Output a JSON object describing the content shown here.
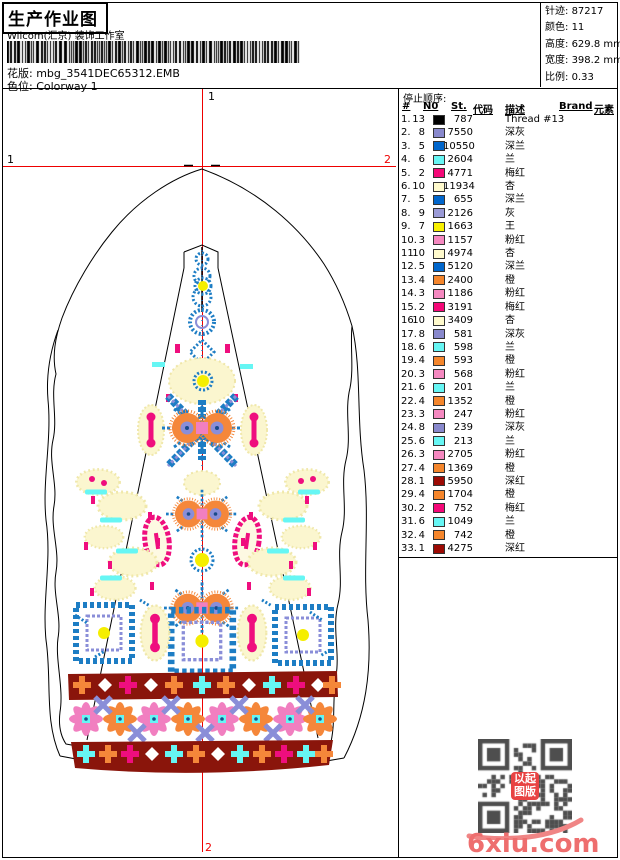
{
  "header": {
    "title": "生产作业图",
    "studio": "Wilcom(汇京) 装饰工作室",
    "pattern_label": "花版:",
    "pattern_value": "mbg_3541DEC65312.EMB",
    "colorway_label": "色位:",
    "colorway_value": "Colorway 1",
    "stats": [
      {
        "label": "针迹:",
        "value": "87217"
      },
      {
        "label": "颜色:",
        "value": "11"
      },
      {
        "label": "高度:",
        "value": "629.8 mm"
      },
      {
        "label": "宽度:",
        "value": "398.2 mm"
      },
      {
        "label": "比例:",
        "value": "0.33"
      }
    ]
  },
  "canvas": {
    "markers": {
      "top": "1",
      "left": "1",
      "right": "2",
      "bottom": "2"
    },
    "crosshair_color": "#ee0000"
  },
  "stop_sequence": {
    "heading": "停止顺序:",
    "columns": [
      "#",
      "N0",
      "St.",
      "代码",
      "描述",
      "Brand",
      "元素"
    ],
    "rows": [
      {
        "seq": "1.",
        "n": "13",
        "chip": "#000000",
        "st": "787",
        "desc": "Thread #13"
      },
      {
        "seq": "2.",
        "n": "8",
        "chip": "#8888cc",
        "st": "7550",
        "desc": "深灰"
      },
      {
        "seq": "3.",
        "n": "5",
        "chip": "#0066cc",
        "st": "10550",
        "desc": "深兰"
      },
      {
        "seq": "4.",
        "n": "6",
        "chip": "#66f6f4",
        "st": "2604",
        "desc": "兰"
      },
      {
        "seq": "5.",
        "n": "2",
        "chip": "#f50878",
        "st": "4771",
        "desc": "梅红"
      },
      {
        "seq": "6.",
        "n": "10",
        "chip": "#fffacc",
        "st": "11934",
        "desc": "杏"
      },
      {
        "seq": "7.",
        "n": "5",
        "chip": "#0066cc",
        "st": "655",
        "desc": "深兰"
      },
      {
        "seq": "8.",
        "n": "9",
        "chip": "#9a9ad6",
        "st": "2126",
        "desc": "灰"
      },
      {
        "seq": "9.",
        "n": "7",
        "chip": "#f8f000",
        "st": "1663",
        "desc": "王"
      },
      {
        "seq": "10.",
        "n": "3",
        "chip": "#f588c0",
        "st": "1157",
        "desc": "粉红"
      },
      {
        "seq": "11.",
        "n": "10",
        "chip": "#fffacc",
        "st": "4974",
        "desc": "杏"
      },
      {
        "seq": "12.",
        "n": "5",
        "chip": "#0066cc",
        "st": "5120",
        "desc": "深兰"
      },
      {
        "seq": "13.",
        "n": "4",
        "chip": "#f5862c",
        "st": "2400",
        "desc": "橙"
      },
      {
        "seq": "14.",
        "n": "3",
        "chip": "#f588c0",
        "st": "1186",
        "desc": "粉红"
      },
      {
        "seq": "15.",
        "n": "2",
        "chip": "#f50878",
        "st": "3191",
        "desc": "梅红"
      },
      {
        "seq": "16.",
        "n": "10",
        "chip": "#fffacc",
        "st": "3409",
        "desc": "杏"
      },
      {
        "seq": "17.",
        "n": "8",
        "chip": "#8888cc",
        "st": "581",
        "desc": "深灰"
      },
      {
        "seq": "18.",
        "n": "6",
        "chip": "#66f6f4",
        "st": "598",
        "desc": "兰"
      },
      {
        "seq": "19.",
        "n": "4",
        "chip": "#f5862c",
        "st": "593",
        "desc": "橙"
      },
      {
        "seq": "20.",
        "n": "3",
        "chip": "#f588c0",
        "st": "568",
        "desc": "粉红"
      },
      {
        "seq": "21.",
        "n": "6",
        "chip": "#66f6f4",
        "st": "201",
        "desc": "兰"
      },
      {
        "seq": "22.",
        "n": "4",
        "chip": "#f5862c",
        "st": "1352",
        "desc": "橙"
      },
      {
        "seq": "23.",
        "n": "3",
        "chip": "#f588c0",
        "st": "247",
        "desc": "粉红"
      },
      {
        "seq": "24.",
        "n": "8",
        "chip": "#8888cc",
        "st": "239",
        "desc": "深灰"
      },
      {
        "seq": "25.",
        "n": "6",
        "chip": "#66f6f4",
        "st": "213",
        "desc": "兰"
      },
      {
        "seq": "26.",
        "n": "3",
        "chip": "#f588c0",
        "st": "2705",
        "desc": "粉红"
      },
      {
        "seq": "27.",
        "n": "4",
        "chip": "#f5862c",
        "st": "1369",
        "desc": "橙"
      },
      {
        "seq": "28.",
        "n": "1",
        "chip": "#9c0a04",
        "st": "5950",
        "desc": "深红"
      },
      {
        "seq": "29.",
        "n": "4",
        "chip": "#f5862c",
        "st": "1704",
        "desc": "橙"
      },
      {
        "seq": "30.",
        "n": "2",
        "chip": "#f50878",
        "st": "752",
        "desc": "梅红"
      },
      {
        "seq": "31.",
        "n": "6",
        "chip": "#66f6f4",
        "st": "1049",
        "desc": "兰"
      },
      {
        "seq": "32.",
        "n": "4",
        "chip": "#f5862c",
        "st": "742",
        "desc": "橙"
      },
      {
        "seq": "33.",
        "n": "1",
        "chip": "#9c0a04",
        "st": "4275",
        "desc": "深红"
      }
    ]
  },
  "watermark": {
    "site": "6xiu.com",
    "seal_lines": [
      "以起",
      "图版"
    ],
    "seal_text": "以图起版"
  },
  "palette": {
    "crosshair_red": "#ee0000",
    "design_blue": "#1d7dc4",
    "band_maroon": "#8a150b",
    "cream": "#fbf6cf",
    "watermark_pink": "#ee6e6e"
  }
}
